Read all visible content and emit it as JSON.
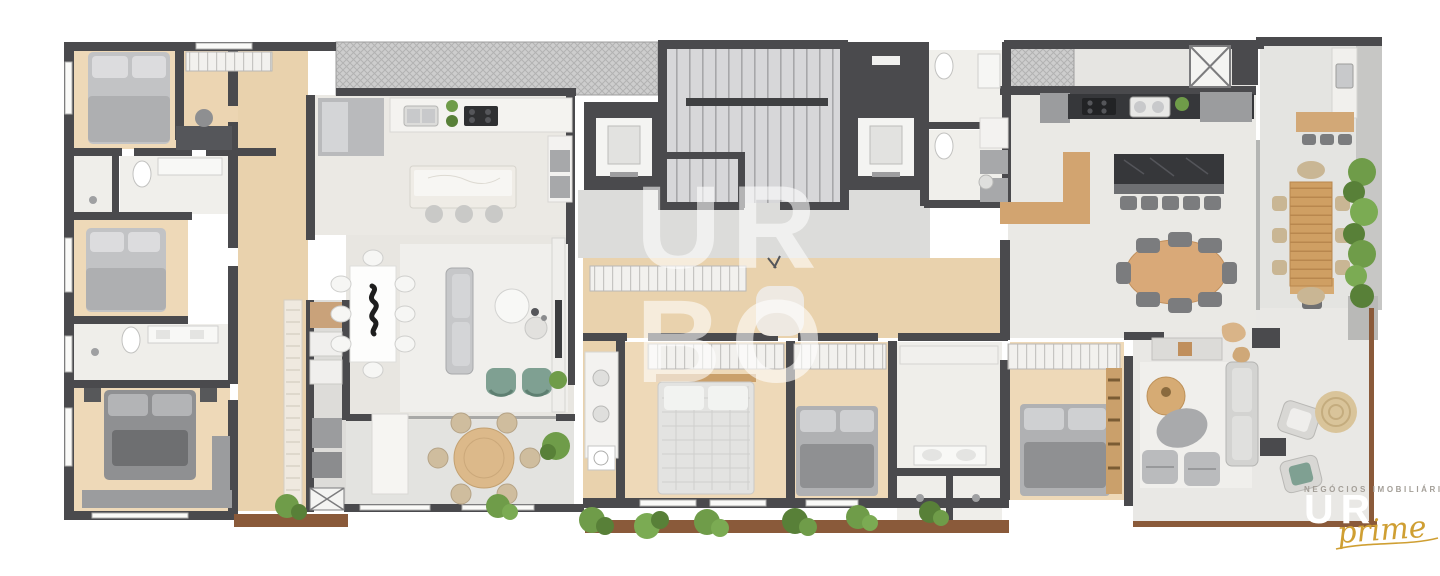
{
  "watermark": {
    "line1": "UR",
    "line2": "BO"
  },
  "logo": {
    "tagline": "NEGÓCIOS IMOBILIÁRIOS",
    "brand": "URBO",
    "script": "prime"
  },
  "colors": {
    "wall_dark": "#4a4a4d",
    "wood_floor": "#eed9b8",
    "wood_corridor": "#e9d2ad",
    "tile_living": "#e8e6e1",
    "tile_kitchen": "#ebe9e4",
    "tile_terrace": "#e3e3e0",
    "tile_bath": "#efeeea",
    "hatch_gray": "#cdcdcd",
    "furniture_wood": "#d2a470",
    "marble_white": "#f6f5f2",
    "counter_dark": "#36373a",
    "sofa_gray": "#c6c7c9",
    "bed_gray": "#b4b5b7",
    "armchair_green": "#7fa092",
    "plant_green": "#6f9c49",
    "deck_brown": "#8a5a3a",
    "logo_gold": "#cf9f33",
    "watermark_white": "rgba(255,255,255,0.58)"
  }
}
